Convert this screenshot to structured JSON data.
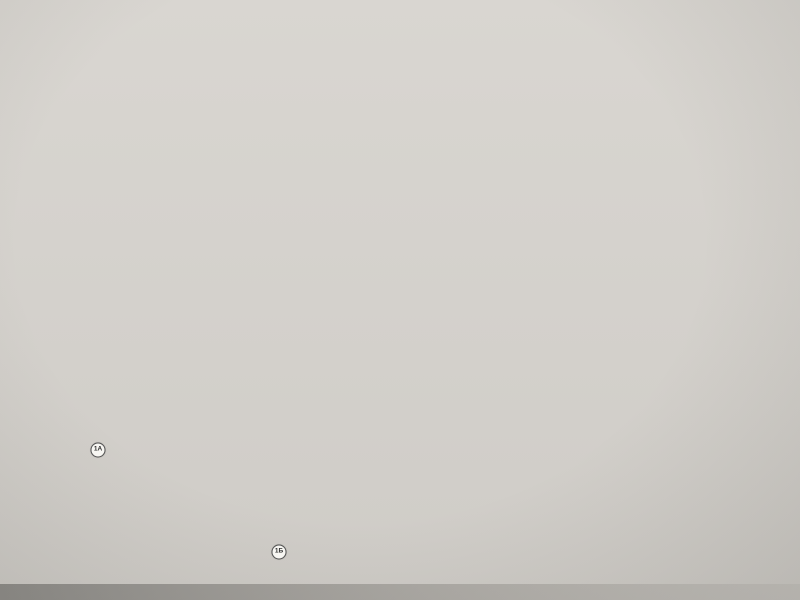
{
  "logos": {
    "volma": {
      "eco": "эко",
      "name": "volma",
      "sub": "ЭКОТЕХНОПАРК",
      "accent": "#79a527"
    },
    "ripo": {
      "name": "РИПО"
    }
  },
  "title": {
    "line1": "РЕСУРСНЫЙ ЦЕНТР",
    "line2": "«ЭКОТЕХНОПАРК – ВОЛМА»",
    "sub1": "Филиал учреждения образования",
    "sub2": "«Республиканский институт",
    "sub3": "профессионального образования»"
  },
  "legend": {
    "existing_label": "Существующие объекты",
    "planned_label": "Планируемые объекты",
    "existing": [
      {
        "num": "1А",
        "label": "Въезд в «ЭкоТехноПарк – Волма»"
      },
      {
        "num": "1Б",
        "label": "Въезд в историко-культурную зону"
      },
      {
        "num": "2",
        "label": "Беседка"
      },
      {
        "num": "3",
        "label": "Ветрогенератор"
      },
      {
        "num": "4",
        "label": "Водонапорная башня"
      },
      {
        "num": "5",
        "label": "Экодом с использованием гибридной энергии"
      },
      {
        "num": "6",
        "label": "Сады"
      },
      {
        "num": "7",
        "label": "Ангар"
      },
      {
        "num": "8",
        "label": "Гараж для сельскохозяйственной техники"
      },
      {
        "num": "9",
        "label": "Артезианская скважина"
      },
      {
        "num": "10",
        "label": "Котельная на биотопливе"
      },
      {
        "num": "11",
        "label": "Лаборатория «Биоэнергетика»"
      },
      {
        "num": "12",
        "label": "Дизельная станция"
      },
      {
        "num": "13",
        "label": "Фермерское хозяйство"
      },
      {
        "num": "14",
        "label": "Хозяйственный блок"
      },
      {
        "num": "15",
        "label": "Трансформаторная подстанция"
      },
      {
        "num": "16",
        "label": "Учебный корпус"
      },
      {
        "num": "17",
        "label": "Гостиница с использованием ВИЭ"
      },
      {
        "num": "18",
        "label": "Тепличное хозяйство с учебными лабораториями"
      },
      {
        "num": "19",
        "label": "Объекты частного сектора"
      },
      {
        "num": "20",
        "label": "Усадьба Ваньковичей"
      },
      {
        "num": "21",
        "label": "Ресторанный комплекс"
      },
      {
        "num": "22",
        "label": "Банный комплекс"
      },
      {
        "num": "23",
        "label": "Очистное сооружение"
      },
      {
        "num": "24",
        "label": "Минигидростанция"
      },
      {
        "num": "25",
        "label": "Мостик"
      },
      {
        "num": "26",
        "label": "Закладной исторический камень"
      },
      {
        "num": "27",
        "label": "Каплица (исторические развалины)"
      }
    ],
    "planned": [
      {
        "num": "28",
        "label": "Парковка"
      },
      {
        "num": "29",
        "label": "Пост охраны"
      },
      {
        "num": "30",
        "label": "Презентационный павильон"
      },
      {
        "num": "31",
        "label": "Станция зарядки электромобилей.",
        "label2": "Парковка электрокаров и велосипедов"
      },
      {
        "num": "32",
        "label": "Полоса препятствий"
      },
      {
        "num": "33",
        "label": "Спортивная площадка"
      },
      {
        "num": "34",
        "label": "Детская площадка"
      },
      {
        "num": "35",
        "label": "Теплицы"
      },
      {
        "num": "36",
        "label": "Кратерный сад"
      },
      {
        "num": "37",
        "label": "Город мастеров"
      },
      {
        "num": "38",
        "label": "Летний амфитеатр"
      },
      {
        "num": "39",
        "label": "Сады"
      },
      {
        "num": "40",
        "label": "Учебно-лабораторный корпус"
      },
      {
        "num": "41",
        "label": "Мост"
      },
      {
        "num": "42",
        "label": "Рыбацкая беседка"
      },
      {
        "num": "43",
        "label": "Навесной мост"
      },
      {
        "num": "44",
        "label": "Гостевые домики"
      },
      {
        "num": "45",
        "label": "Банный комплекс"
      }
    ],
    "lines": [
      {
        "label": "Туристические тропы",
        "color": "#c2552b"
      },
      {
        "label": "Транспортная инфраструктура",
        "color": "#8a8a8a"
      }
    ]
  },
  "map": {
    "labels": {
      "grove": "Ивовая роща",
      "park": "Приусадебный парк"
    },
    "compass": {
      "top": "E",
      "right": "S",
      "bottom": "W",
      "left": "N"
    },
    "markers": [
      {
        "n": "39",
        "x": 182,
        "y": 72,
        "t": "p"
      },
      {
        "n": "41",
        "x": 253,
        "y": 155,
        "t": "p"
      },
      {
        "n": "25",
        "x": 312,
        "y": 152,
        "t": "e"
      },
      {
        "n": "27",
        "x": 347,
        "y": 150,
        "t": "e"
      },
      {
        "n": "20",
        "x": 222,
        "y": 198,
        "t": "e"
      },
      {
        "n": "21",
        "x": 352,
        "y": 200,
        "t": "e"
      },
      {
        "n": "22",
        "x": 366,
        "y": 213,
        "t": "e"
      },
      {
        "n": "44",
        "x": 403,
        "y": 212,
        "t": "p"
      },
      {
        "n": "45",
        "x": 420,
        "y": 234,
        "t": "p"
      },
      {
        "n": "43",
        "x": 357,
        "y": 237,
        "t": "p"
      },
      {
        "n": "42",
        "x": 374,
        "y": 263,
        "t": "p"
      },
      {
        "n": "15",
        "x": 200,
        "y": 245,
        "t": "e"
      },
      {
        "n": "12",
        "x": 231,
        "y": 246,
        "t": "e"
      },
      {
        "n": "16",
        "x": 306,
        "y": 262,
        "t": "e"
      },
      {
        "n": "17",
        "x": 308,
        "y": 281,
        "t": "e"
      },
      {
        "n": "18",
        "x": 330,
        "y": 276,
        "t": "e"
      },
      {
        "n": "35",
        "x": 243,
        "y": 272,
        "t": "p"
      },
      {
        "n": "34",
        "x": 208,
        "y": 283,
        "t": "p"
      },
      {
        "n": "8",
        "x": 150,
        "y": 290,
        "t": "e"
      },
      {
        "n": "38",
        "x": 262,
        "y": 300,
        "t": "p"
      },
      {
        "n": "24",
        "x": 382,
        "y": 288,
        "t": "e"
      },
      {
        "n": "23",
        "x": 396,
        "y": 300,
        "t": "e"
      },
      {
        "n": "19",
        "x": 435,
        "y": 318,
        "t": "e"
      },
      {
        "n": "10",
        "x": 223,
        "y": 312,
        "t": "e"
      },
      {
        "n": "14",
        "x": 241,
        "y": 318,
        "t": "e"
      },
      {
        "n": "33",
        "x": 175,
        "y": 310,
        "t": "p"
      },
      {
        "n": "40",
        "x": 322,
        "y": 332,
        "t": "p"
      },
      {
        "n": "36",
        "x": 292,
        "y": 352,
        "t": "p"
      },
      {
        "n": "26",
        "x": 286,
        "y": 331,
        "t": "e"
      },
      {
        "n": "13",
        "x": 263,
        "y": 331,
        "t": "e"
      },
      {
        "n": "11",
        "x": 217,
        "y": 336,
        "t": "e"
      },
      {
        "n": "6",
        "x": 171,
        "y": 324,
        "t": "e"
      },
      {
        "n": "5",
        "x": 163,
        "y": 340,
        "t": "e"
      },
      {
        "n": "3",
        "x": 87,
        "y": 339,
        "t": "e"
      },
      {
        "n": "2",
        "x": 96,
        "y": 348,
        "t": "e"
      },
      {
        "n": "7",
        "x": 188,
        "y": 344,
        "t": "e"
      },
      {
        "n": "30",
        "x": 113,
        "y": 324,
        "t": "p"
      },
      {
        "n": "28",
        "x": 118,
        "y": 338,
        "t": "p"
      },
      {
        "n": "31",
        "x": 137,
        "y": 352,
        "t": "p"
      },
      {
        "n": "32",
        "x": 120,
        "y": 365,
        "t": "p"
      },
      {
        "n": "9",
        "x": 209,
        "y": 362,
        "t": "e"
      },
      {
        "n": "37",
        "x": 228,
        "y": 362,
        "t": "p"
      },
      {
        "n": "4",
        "x": 153,
        "y": 377,
        "t": "e"
      },
      {
        "n": "29",
        "x": 88,
        "y": 380,
        "t": "p"
      },
      {
        "n": "1А",
        "x": 93,
        "y": 400,
        "t": "big"
      },
      {
        "n": "1Б",
        "x": 274,
        "y": 502,
        "t": "big"
      }
    ]
  }
}
